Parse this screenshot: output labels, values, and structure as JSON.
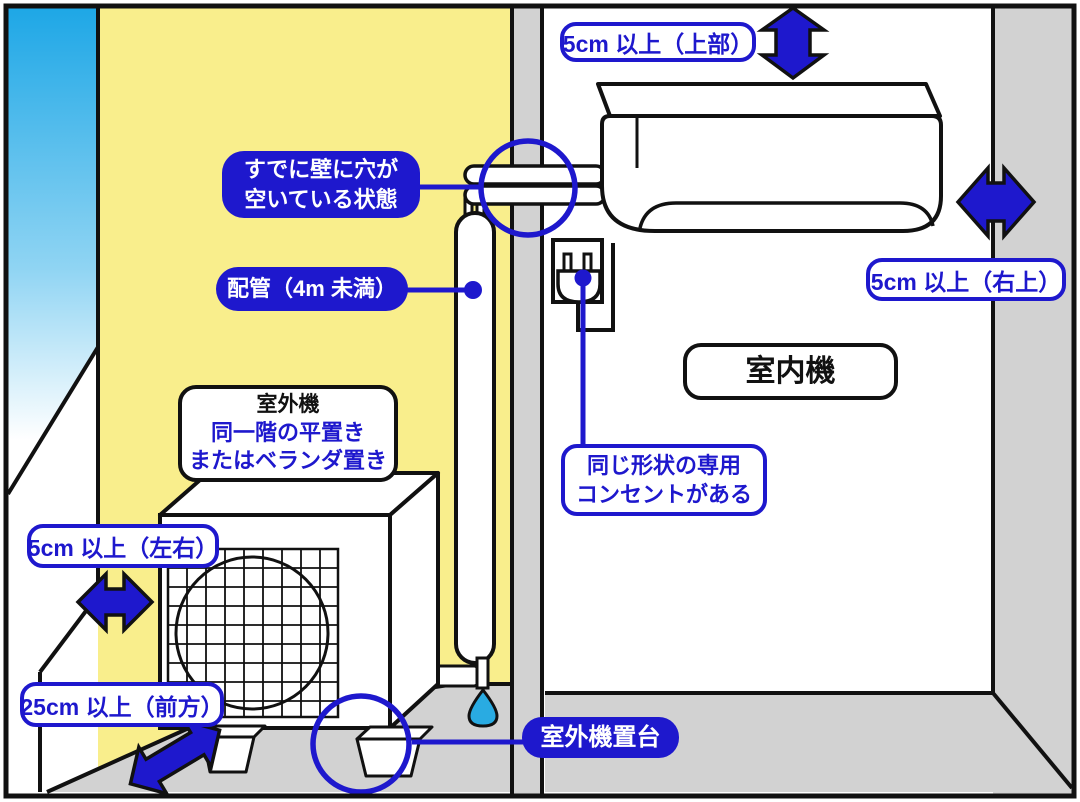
{
  "colors": {
    "accent_blue": "#1e18cd",
    "wall_yellow": "#f9ee8c",
    "wall_gray": "#d2d2d2",
    "sky_blue": "#1ea7e6",
    "water_drop_blue": "#29abe2",
    "outline_black": "#111111"
  },
  "labels": {
    "clearance_top": "5cm 以上（上部）",
    "clearance_right": "5cm 以上（右上）",
    "wall_hole_line1": "すでに壁に穴が",
    "wall_hole_line2": "空いている状態",
    "piping": "配管（4m 未満）",
    "outdoor_unit_title": "室外機",
    "outdoor_unit_line1": "同一階の平置き",
    "outdoor_unit_line2": "またはベランダ置き",
    "indoor_unit": "室内機",
    "outlet_line1": "同じ形状の専用",
    "outlet_line2": "コンセントがある",
    "clearance_side": "5cm 以上（左右）",
    "clearance_front": "25cm 以上（前方）",
    "stand": "室外機置台"
  },
  "icons": {
    "arrow_vertical": "double-arrow-up-down",
    "arrow_horizontal_right": "double-arrow-left-right",
    "arrow_horizontal_side": "double-arrow-left-right",
    "arrow_diagonal_front": "double-arrow-diagonal",
    "plug": "power-plug",
    "water_drop": "water-drop",
    "wall_hole_ring": "circle-annotation",
    "stand_ring": "circle-annotation"
  }
}
